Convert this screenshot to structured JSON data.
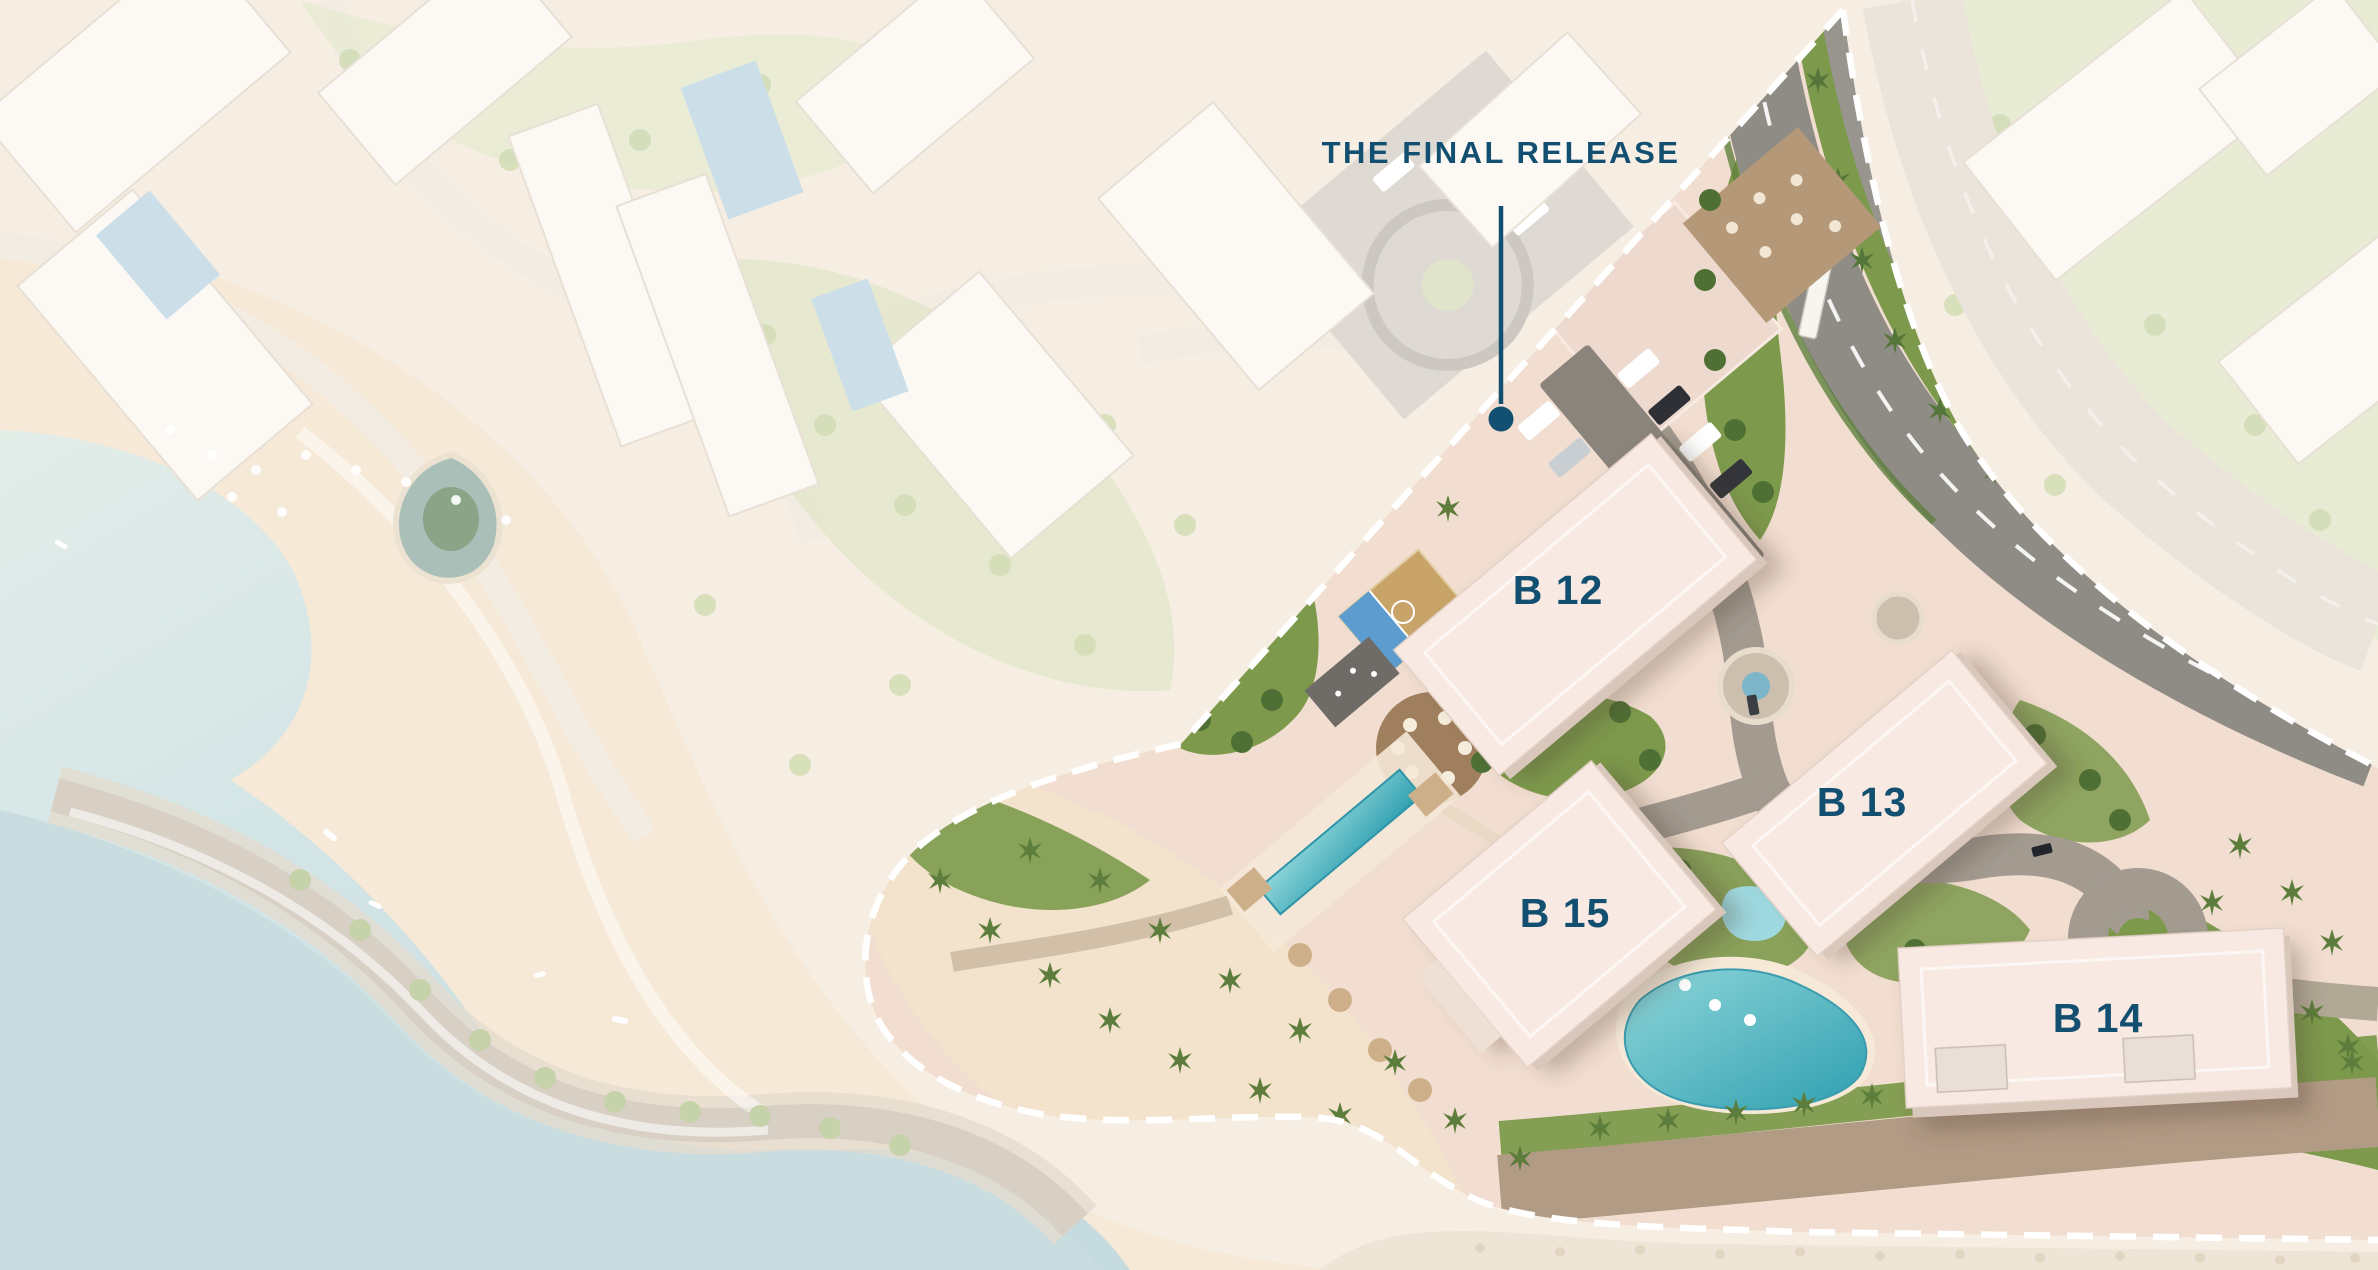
{
  "annotation": {
    "title": "THE FINAL RELEASE"
  },
  "buildings": [
    {
      "id": "b12",
      "label": "B 12"
    },
    {
      "id": "b13",
      "label": "B 13"
    },
    {
      "id": "b15",
      "label": "B 15"
    },
    {
      "id": "b14",
      "label": "B 14"
    }
  ],
  "colors": {
    "annotation_navy": "#134f70",
    "boundary_dash": "#ffffff",
    "landscape_green": "#7d9a4c",
    "tree_green": "#4f7034",
    "palm_green": "#5c7d3b",
    "road_asphalt": "#8f8c86",
    "pool_teal": "#41aebc",
    "pool_teal_light": "#8fd6da",
    "site_ground_blush": "#f2ded0",
    "building_roof": "#f8eae3",
    "plaza_tan": "#b59877",
    "promenade_brown": "#b29b85",
    "faded_ground": "#f7eee3",
    "faded_water": "#cfe2e6"
  }
}
